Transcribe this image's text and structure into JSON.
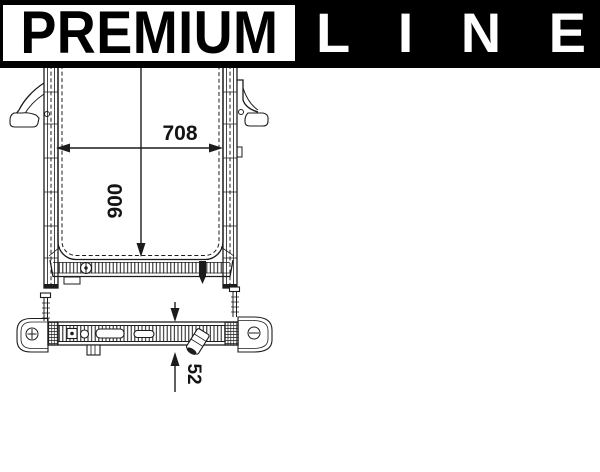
{
  "drawing": {
    "type": "radiator-technical-drawing",
    "views": {
      "front": {
        "width_label": "708",
        "height_label": "900"
      },
      "side": {
        "depth_label": "52"
      }
    },
    "line_color": "#1c1c1c",
    "background_color": "#ffffff"
  },
  "branding": {
    "premium_label": "PREMIUM",
    "line_letters": [
      "L",
      "I",
      "N",
      "E"
    ],
    "banner_bg": "#000000",
    "badge_bg": "#ffffff",
    "badge_text_color": "#000000",
    "line_text_color": "#ffffff"
  }
}
